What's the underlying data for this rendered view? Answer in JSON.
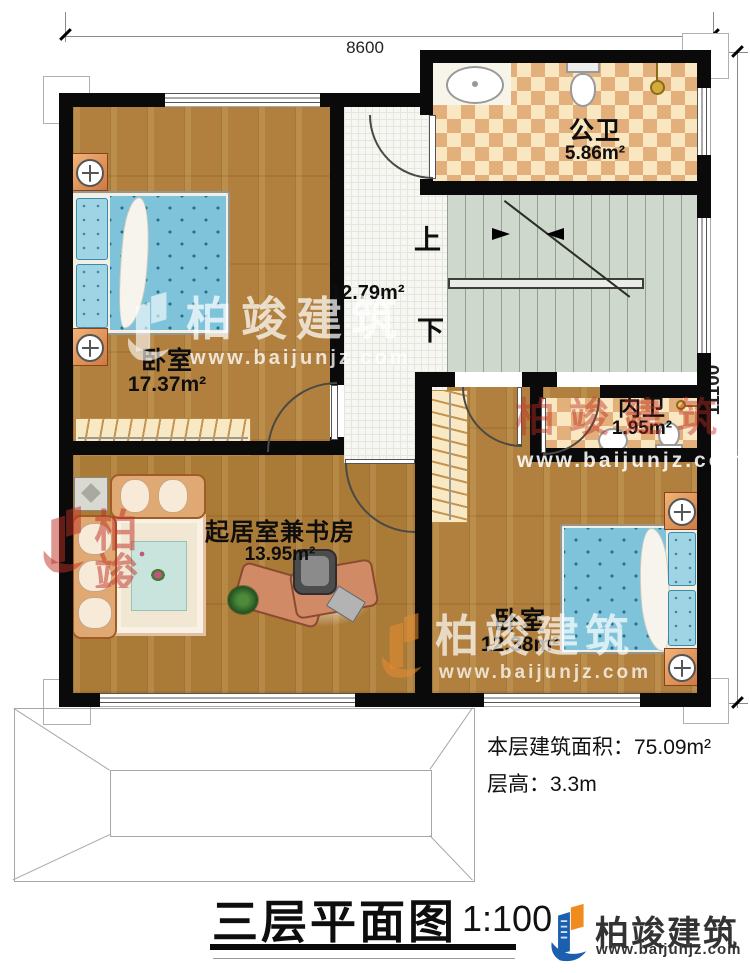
{
  "dims": {
    "top": "8600",
    "right": "11100"
  },
  "rooms": {
    "public_bath": {
      "name": "公卫",
      "area": "5.86m²"
    },
    "bedroom1": {
      "name": "卧室",
      "area": "17.37m²"
    },
    "hall": {
      "area": "12.79m²"
    },
    "inner_bath": {
      "name": "内卫",
      "area": "1.95m²"
    },
    "living_study": {
      "name": "起居室兼书房",
      "area": "13.95m²"
    },
    "bedroom2": {
      "name": "卧室",
      "area": "12.38m²"
    }
  },
  "stairs": {
    "up": "上",
    "down": "下"
  },
  "notes": {
    "area": "本层建筑面积：75.09m²",
    "height": "层高：3.3m"
  },
  "title": {
    "name": "三层平面图",
    "scale": "1:100"
  },
  "brand": {
    "name": "柏竣建筑",
    "url": "www.baijunjz.com"
  },
  "watermark": {
    "name": "柏竣建筑",
    "url": "www.baijunjz.com",
    "partial": "柏竣"
  },
  "colors": {
    "wall": "#0a0a0a",
    "logo_blue": "#1b5fae",
    "logo_orange": "#f08c1e",
    "bed_blue": "#7fc3da",
    "tile_tan": "#e3b07b",
    "watermark_red": "#be2d23"
  }
}
